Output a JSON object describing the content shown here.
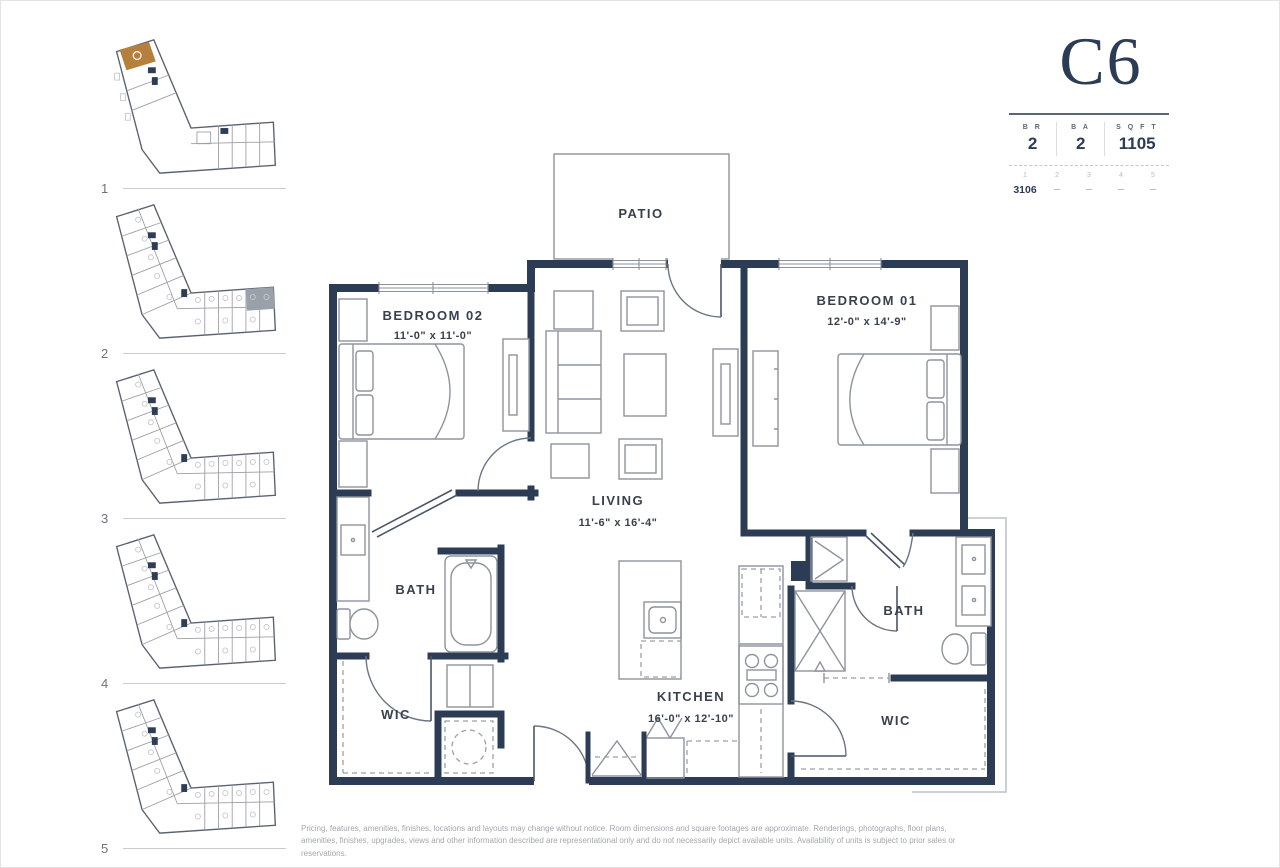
{
  "unit": {
    "name": "C6",
    "stats": [
      {
        "label": "B R",
        "value": "2"
      },
      {
        "label": "B A",
        "value": "2"
      },
      {
        "label": "S Q  F T",
        "value": "1105"
      }
    ],
    "floors": [
      "1",
      "2",
      "3",
      "4",
      "5"
    ],
    "availability": [
      "3106",
      "–",
      "–",
      "–",
      "–"
    ]
  },
  "sidebar": {
    "levels": [
      {
        "number": "1"
      },
      {
        "number": "2"
      },
      {
        "number": "3"
      },
      {
        "number": "4"
      },
      {
        "number": "5"
      }
    ]
  },
  "plan": {
    "rooms": {
      "patio": {
        "label": "PATIO"
      },
      "bedroom02": {
        "label": "BEDROOM 02",
        "dims": "11'-0\" x 11'-0\""
      },
      "bedroom01": {
        "label": "BEDROOM 01",
        "dims": "12'-0\" x 14'-9\""
      },
      "living": {
        "label": "LIVING",
        "dims": "11'-6\" x 16'-4\""
      },
      "kitchen": {
        "label": "KITCHEN",
        "dims": "16'-0\" x 12'-10\""
      },
      "bath_left": {
        "label": "BATH"
      },
      "bath_right": {
        "label": "BATH"
      },
      "wic_left": {
        "label": "WIC"
      },
      "wic_right": {
        "label": "WIC"
      }
    }
  },
  "colors": {
    "wall": "#2d3c55",
    "highlight": "#b5803e",
    "accent": "#2d3c55",
    "amenity_gray": "#9ba1a9"
  },
  "disclaimer": "Pricing, features, amenities, finishes, locations and layouts may change without notice. Room dimensions and square footages are approximate. Renderings, photographs, floor plans, amenities, finishes, upgrades, views and other information described are representational only and do not necessarily depict available units. Availability of units is subject to prior sales or reservations."
}
